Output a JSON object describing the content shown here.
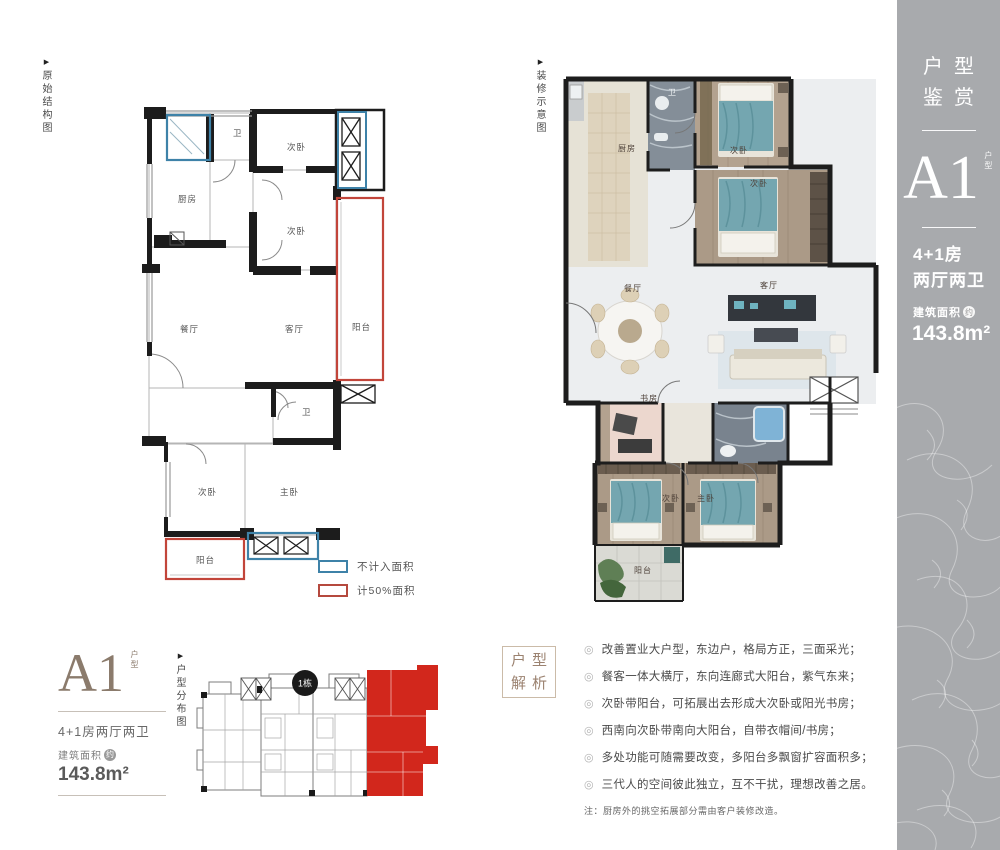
{
  "colors": {
    "accent_red": "#cc2a1d",
    "accent_blue": "#3e82a8",
    "panel_gray": "#a8aaad",
    "taupe": "#8b7b6c"
  },
  "icons": {
    "arrow": "▶",
    "bullet": "◎"
  },
  "tags": {
    "original_plan": "原始结构图",
    "decorated_plan": "装修示意图",
    "distribution_plan": "户型分布图"
  },
  "side_panel": {
    "title_line1": "户型",
    "title_line2": "鉴赏",
    "unit_code": "A1",
    "unit_code_suffix": "户型",
    "layout_line1": "4+1房",
    "layout_line2": "两厅两卫",
    "area_label": "建筑面积",
    "area_circle": "约",
    "area_value": "143.8m²"
  },
  "unit_card": {
    "unit_code": "A1",
    "unit_code_suffix": "户型",
    "layout": "4+1房两厅两卫",
    "area_label": "建筑面积",
    "area_circle": "约",
    "area_value": "143.8m²"
  },
  "plan_original": {
    "rooms": [
      "厨房",
      "卫",
      "次卧",
      "次卧",
      "餐厅",
      "客厅",
      "阳台",
      "卫",
      "次卧",
      "主卧",
      "阳台"
    ]
  },
  "plan_decorated": {
    "rooms": [
      "厨房",
      "卫",
      "次卧",
      "次卧",
      "餐厅",
      "客厅",
      "书房",
      "次卧",
      "主卧",
      "阳台"
    ]
  },
  "legend": {
    "items": [
      {
        "label": "不计入面积",
        "color": "#3e82a8"
      },
      {
        "label": "计50%面积",
        "color": "#b5493e"
      }
    ]
  },
  "distribution": {
    "building_badge": "1栋"
  },
  "analysis": {
    "box_line1": "户型",
    "box_line2": "解析",
    "bullets": [
      "改善置业大户型，东边户，格局方正，三面采光；",
      "餐客一体大横厅，东向连廊式大阳台，紫气东来；",
      "次卧带阳台，可拓展出去形成大次卧或阳光书房；",
      "西南向次卧带南向大阳台，自带衣帽间/书房；",
      "多处功能可随需要改变，多阳台多飘窗扩容面积多；",
      "三代人的空间彼此独立，互不干扰，理想改善之居。"
    ],
    "note": "注：厨房外的挑空拓展部分需由客户装修改造。"
  }
}
